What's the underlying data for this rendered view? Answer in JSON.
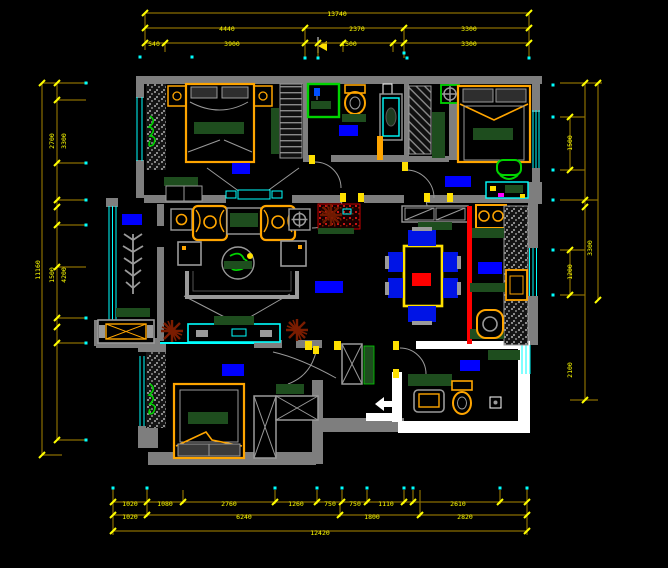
{
  "canvas": {
    "width": 668,
    "height": 568,
    "background": "#000000"
  },
  "drawing_type": "apartment-floor-plan-cad",
  "colors": {
    "background": "#000000",
    "wall": "#7e7e7e",
    "wall_white": "#ffffff",
    "window": "#00ffff",
    "dimension_line": "#8a6e00",
    "dimension_tick": "#ffff00",
    "dimension_text": "#ffff00",
    "room_label": "#0000ff",
    "furniture_accent": "#ffa500",
    "textile_green": "#1e4d1e",
    "bright_green": "#00d400",
    "highlight_red": "#ff0000",
    "plant_brown": "#7a1c00",
    "chair_blue": "#0014e6",
    "magenta": "#ff00ff"
  },
  "rooms": [
    {
      "id": "bedroom-top-left"
    },
    {
      "id": "bathroom-top"
    },
    {
      "id": "closet-hall"
    },
    {
      "id": "bedroom-top-right"
    },
    {
      "id": "balcony"
    },
    {
      "id": "living-room"
    },
    {
      "id": "dining-area"
    },
    {
      "id": "kitchen"
    },
    {
      "id": "hallway"
    },
    {
      "id": "entry"
    },
    {
      "id": "bedroom-bottom"
    },
    {
      "id": "bathroom-bottom-right"
    }
  ],
  "dimensions": {
    "lines": [
      [
        145,
        13,
        529,
        13
      ],
      [
        145,
        28,
        529,
        28
      ],
      [
        145,
        43,
        529,
        43
      ],
      [
        145,
        13,
        145,
        50
      ],
      [
        529,
        13,
        529,
        58
      ],
      [
        165,
        43,
        165,
        52
      ],
      [
        305,
        28,
        305,
        58
      ],
      [
        318,
        43,
        318,
        58
      ],
      [
        343,
        43,
        343,
        52
      ],
      [
        393,
        43,
        393,
        52
      ],
      [
        404,
        28,
        404,
        58
      ],
      [
        113,
        502,
        527,
        502
      ],
      [
        113,
        515,
        527,
        515
      ],
      [
        113,
        531,
        527,
        531
      ],
      [
        113,
        488,
        113,
        535
      ],
      [
        527,
        488,
        527,
        535
      ],
      [
        147,
        488,
        147,
        517
      ],
      [
        183,
        490,
        183,
        504
      ],
      [
        275,
        490,
        275,
        504
      ],
      [
        317,
        490,
        317,
        504
      ],
      [
        342,
        490,
        342,
        504
      ],
      [
        367,
        490,
        367,
        504
      ],
      [
        404,
        490,
        404,
        504
      ],
      [
        413,
        490,
        413,
        504
      ],
      [
        500,
        490,
        500,
        504
      ],
      [
        340,
        504,
        340,
        517
      ],
      [
        420,
        490,
        420,
        517
      ],
      [
        42,
        83,
        42,
        455
      ],
      [
        57,
        83,
        57,
        440
      ],
      [
        42,
        83,
        88,
        83
      ],
      [
        57,
        100,
        86,
        100
      ],
      [
        57,
        163,
        86,
        163
      ],
      [
        57,
        200,
        86,
        200
      ],
      [
        57,
        225,
        86,
        225
      ],
      [
        57,
        267,
        86,
        267
      ],
      [
        57,
        318,
        86,
        318
      ],
      [
        57,
        343,
        86,
        343
      ],
      [
        57,
        440,
        86,
        440
      ],
      [
        42,
        455,
        62,
        455
      ],
      [
        585,
        83,
        585,
        400
      ],
      [
        598,
        83,
        598,
        300
      ],
      [
        570,
        117,
        570,
        170
      ],
      [
        570,
        250,
        570,
        295
      ],
      [
        560,
        83,
        602,
        83
      ],
      [
        560,
        117,
        585,
        117
      ],
      [
        560,
        170,
        585,
        170
      ],
      [
        560,
        200,
        598,
        200
      ],
      [
        560,
        250,
        585,
        250
      ],
      [
        560,
        295,
        585,
        295
      ],
      [
        570,
        400,
        598,
        400
      ]
    ],
    "ticks": [
      [
        145,
        43
      ],
      [
        165,
        43
      ],
      [
        305,
        43
      ],
      [
        318,
        43
      ],
      [
        343,
        43
      ],
      [
        393,
        43
      ],
      [
        404,
        43
      ],
      [
        529,
        43
      ],
      [
        145,
        28
      ],
      [
        305,
        28
      ],
      [
        404,
        28
      ],
      [
        529,
        28
      ],
      [
        145,
        13
      ],
      [
        529,
        13
      ],
      [
        113,
        502
      ],
      [
        147,
        502
      ],
      [
        183,
        502
      ],
      [
        275,
        502
      ],
      [
        317,
        502
      ],
      [
        342,
        502
      ],
      [
        367,
        502
      ],
      [
        404,
        502
      ],
      [
        413,
        502
      ],
      [
        500,
        502
      ],
      [
        527,
        502
      ],
      [
        113,
        515
      ],
      [
        147,
        515
      ],
      [
        340,
        515
      ],
      [
        420,
        515
      ],
      [
        527,
        515
      ],
      [
        113,
        531
      ],
      [
        527,
        531
      ],
      [
        57,
        83
      ],
      [
        57,
        100
      ],
      [
        57,
        163
      ],
      [
        57,
        200
      ],
      [
        57,
        207
      ],
      [
        57,
        225
      ],
      [
        57,
        267
      ],
      [
        57,
        318
      ],
      [
        57,
        327
      ],
      [
        57,
        343
      ],
      [
        57,
        440
      ],
      [
        42,
        83
      ],
      [
        42,
        455
      ],
      [
        585,
        83
      ],
      [
        585,
        200
      ],
      [
        585,
        207
      ],
      [
        585,
        400
      ],
      [
        598,
        83
      ],
      [
        598,
        300
      ],
      [
        570,
        117
      ],
      [
        570,
        170
      ],
      [
        570,
        250
      ],
      [
        570,
        295
      ]
    ],
    "dots": [
      [
        140,
        57
      ],
      [
        192,
        57
      ],
      [
        305,
        58
      ],
      [
        318,
        58
      ],
      [
        404,
        53
      ],
      [
        407,
        58
      ],
      [
        529,
        58
      ],
      [
        113,
        488
      ],
      [
        147,
        488
      ],
      [
        275,
        488
      ],
      [
        317,
        488
      ],
      [
        342,
        488
      ],
      [
        367,
        488
      ],
      [
        404,
        488
      ],
      [
        413,
        488
      ],
      [
        500,
        488
      ],
      [
        527,
        488
      ],
      [
        86,
        83
      ],
      [
        86,
        163
      ],
      [
        86,
        200
      ],
      [
        86,
        225
      ],
      [
        86,
        318
      ],
      [
        86,
        343
      ],
      [
        86,
        440
      ],
      [
        553,
        85
      ],
      [
        553,
        117
      ],
      [
        553,
        170
      ],
      [
        553,
        200
      ],
      [
        553,
        250
      ],
      [
        553,
        295
      ]
    ],
    "labels": [
      {
        "x": 337,
        "y": 16,
        "v": "13740"
      },
      {
        "x": 227,
        "y": 31,
        "v": "4440"
      },
      {
        "x": 357,
        "y": 31,
        "v": "2370"
      },
      {
        "x": 469,
        "y": 31,
        "v": "3300"
      },
      {
        "x": 154,
        "y": 46,
        "v": "540"
      },
      {
        "x": 232,
        "y": 46,
        "v": "3900"
      },
      {
        "x": 349,
        "y": 46,
        "v": "1500"
      },
      {
        "x": 469,
        "y": 46,
        "v": "3300"
      },
      {
        "x": 130,
        "y": 506,
        "v": "1020"
      },
      {
        "x": 165,
        "y": 506,
        "v": "1080"
      },
      {
        "x": 229,
        "y": 506,
        "v": "2760"
      },
      {
        "x": 296,
        "y": 506,
        "v": "1260"
      },
      {
        "x": 330,
        "y": 506,
        "v": "750"
      },
      {
        "x": 355,
        "y": 506,
        "v": "750"
      },
      {
        "x": 386,
        "y": 506,
        "v": "1110"
      },
      {
        "x": 458,
        "y": 506,
        "v": "2610"
      },
      {
        "x": 130,
        "y": 519,
        "v": "1020"
      },
      {
        "x": 244,
        "y": 519,
        "v": "6240"
      },
      {
        "x": 372,
        "y": 519,
        "v": "1800"
      },
      {
        "x": 465,
        "y": 519,
        "v": "2820"
      },
      {
        "x": 320,
        "y": 535,
        "v": "12420"
      },
      {
        "x": 54,
        "y": 141,
        "v": "2700",
        "rot": -90
      },
      {
        "x": 66,
        "y": 141,
        "v": "3300",
        "rot": -90
      },
      {
        "x": 54,
        "y": 275,
        "v": "1500",
        "rot": -90
      },
      {
        "x": 66,
        "y": 275,
        "v": "4200",
        "rot": -90
      },
      {
        "x": 40,
        "y": 270,
        "v": "11160",
        "rot": -90
      },
      {
        "x": 572,
        "y": 143,
        "v": "1500",
        "rot": -90
      },
      {
        "x": 592,
        "y": 248,
        "v": "3300",
        "rot": -90
      },
      {
        "x": 572,
        "y": 272,
        "v": "1200",
        "rot": -90
      },
      {
        "x": 572,
        "y": 370,
        "v": "2100",
        "rot": -90
      }
    ]
  }
}
